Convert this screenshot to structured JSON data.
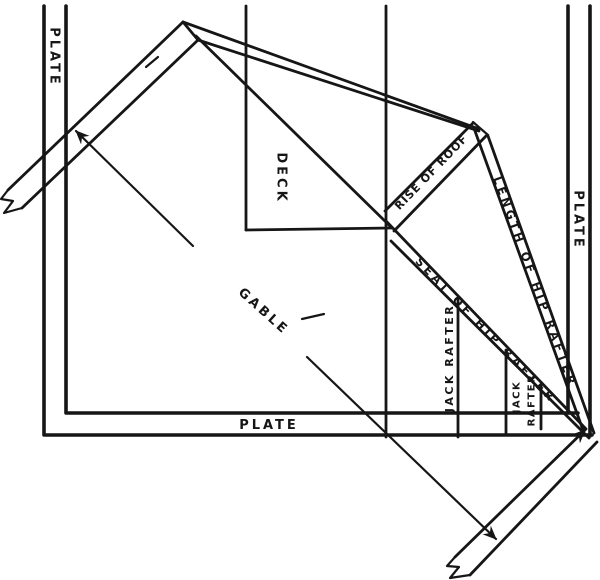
{
  "diagram": {
    "type": "hip-roof framing line diagram",
    "labels": {
      "plate_left": "PLATE",
      "plate_right": "PLATE",
      "plate_bottom": "PLATE",
      "deck": "DECK",
      "gable": "GABLE",
      "rise_of_roof": "RISE OF ROOF",
      "length_of_hip_rafter": "LENGTH OF HIP RAFTER",
      "seat_of_hip_rafter": "SEAT OF HIP RAFTER",
      "jack_rafter_long": "JACK RAFTER",
      "jack_rafter_short_line1": "JACK",
      "jack_rafter_short_line2": "RAFTER"
    },
    "colors": {
      "ink": "#161616",
      "paper": "#ffffff"
    }
  }
}
